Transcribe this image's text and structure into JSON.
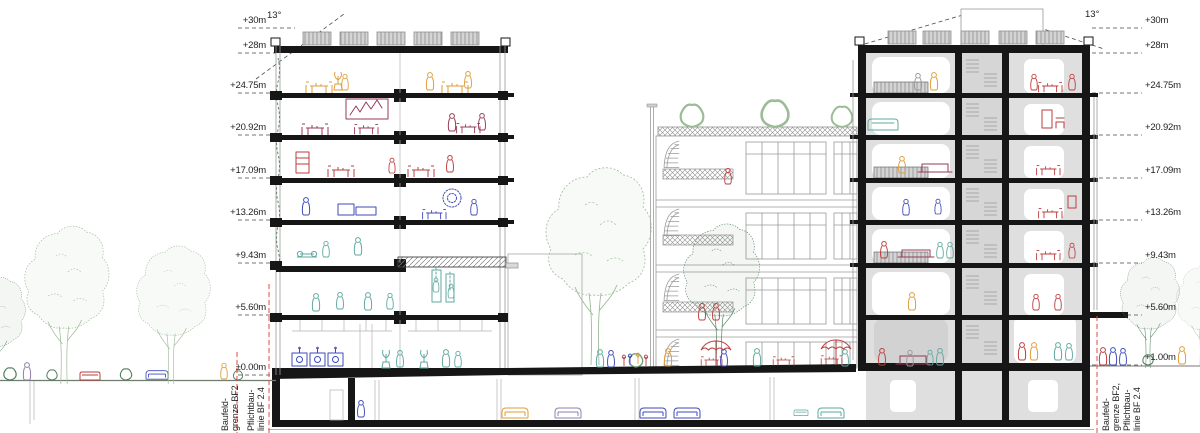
{
  "drawing": {
    "kind": "architectural cross section",
    "angle_left": "13°",
    "angle_right": "13°"
  },
  "labels": {
    "levels_left": [
      "+30m",
      "+28m",
      "+24.75m",
      "+20.92m",
      "+17.09m",
      "+13.26m",
      "+9.43m",
      "+5.60m",
      "±0.00m"
    ],
    "levels_right": [
      "+30m",
      "+28m",
      "+24.75m",
      "+20.92m",
      "+17.09m",
      "+13.26m",
      "+9.43m",
      "+5.60m",
      "+1.00m"
    ],
    "boundary_left_a": [
      "Baufeld-",
      "grenze BF2"
    ],
    "boundary_left_b": [
      "Pflichtbau-",
      "linie BF 2.4"
    ],
    "boundary_right": [
      "Baufeld-",
      "grenze BF2,",
      "Pflichtbau-",
      "linie BF 2.4"
    ]
  },
  "palette": {
    "structure_black": "#161616",
    "light_line_gray": "#9a9a9a",
    "room_gray": "#dfdfdf",
    "boundary_red": "#e14b40",
    "sketch_orange": "#df9e3c",
    "sketch_red": "#bb3d3f",
    "sketch_darkred": "#973b55",
    "sketch_blue": "#3f4bb8",
    "sketch_teal": "#5fa9a0",
    "tree_green_dark": "#4e7d58",
    "tree_green_light": "#9cbc97"
  }
}
